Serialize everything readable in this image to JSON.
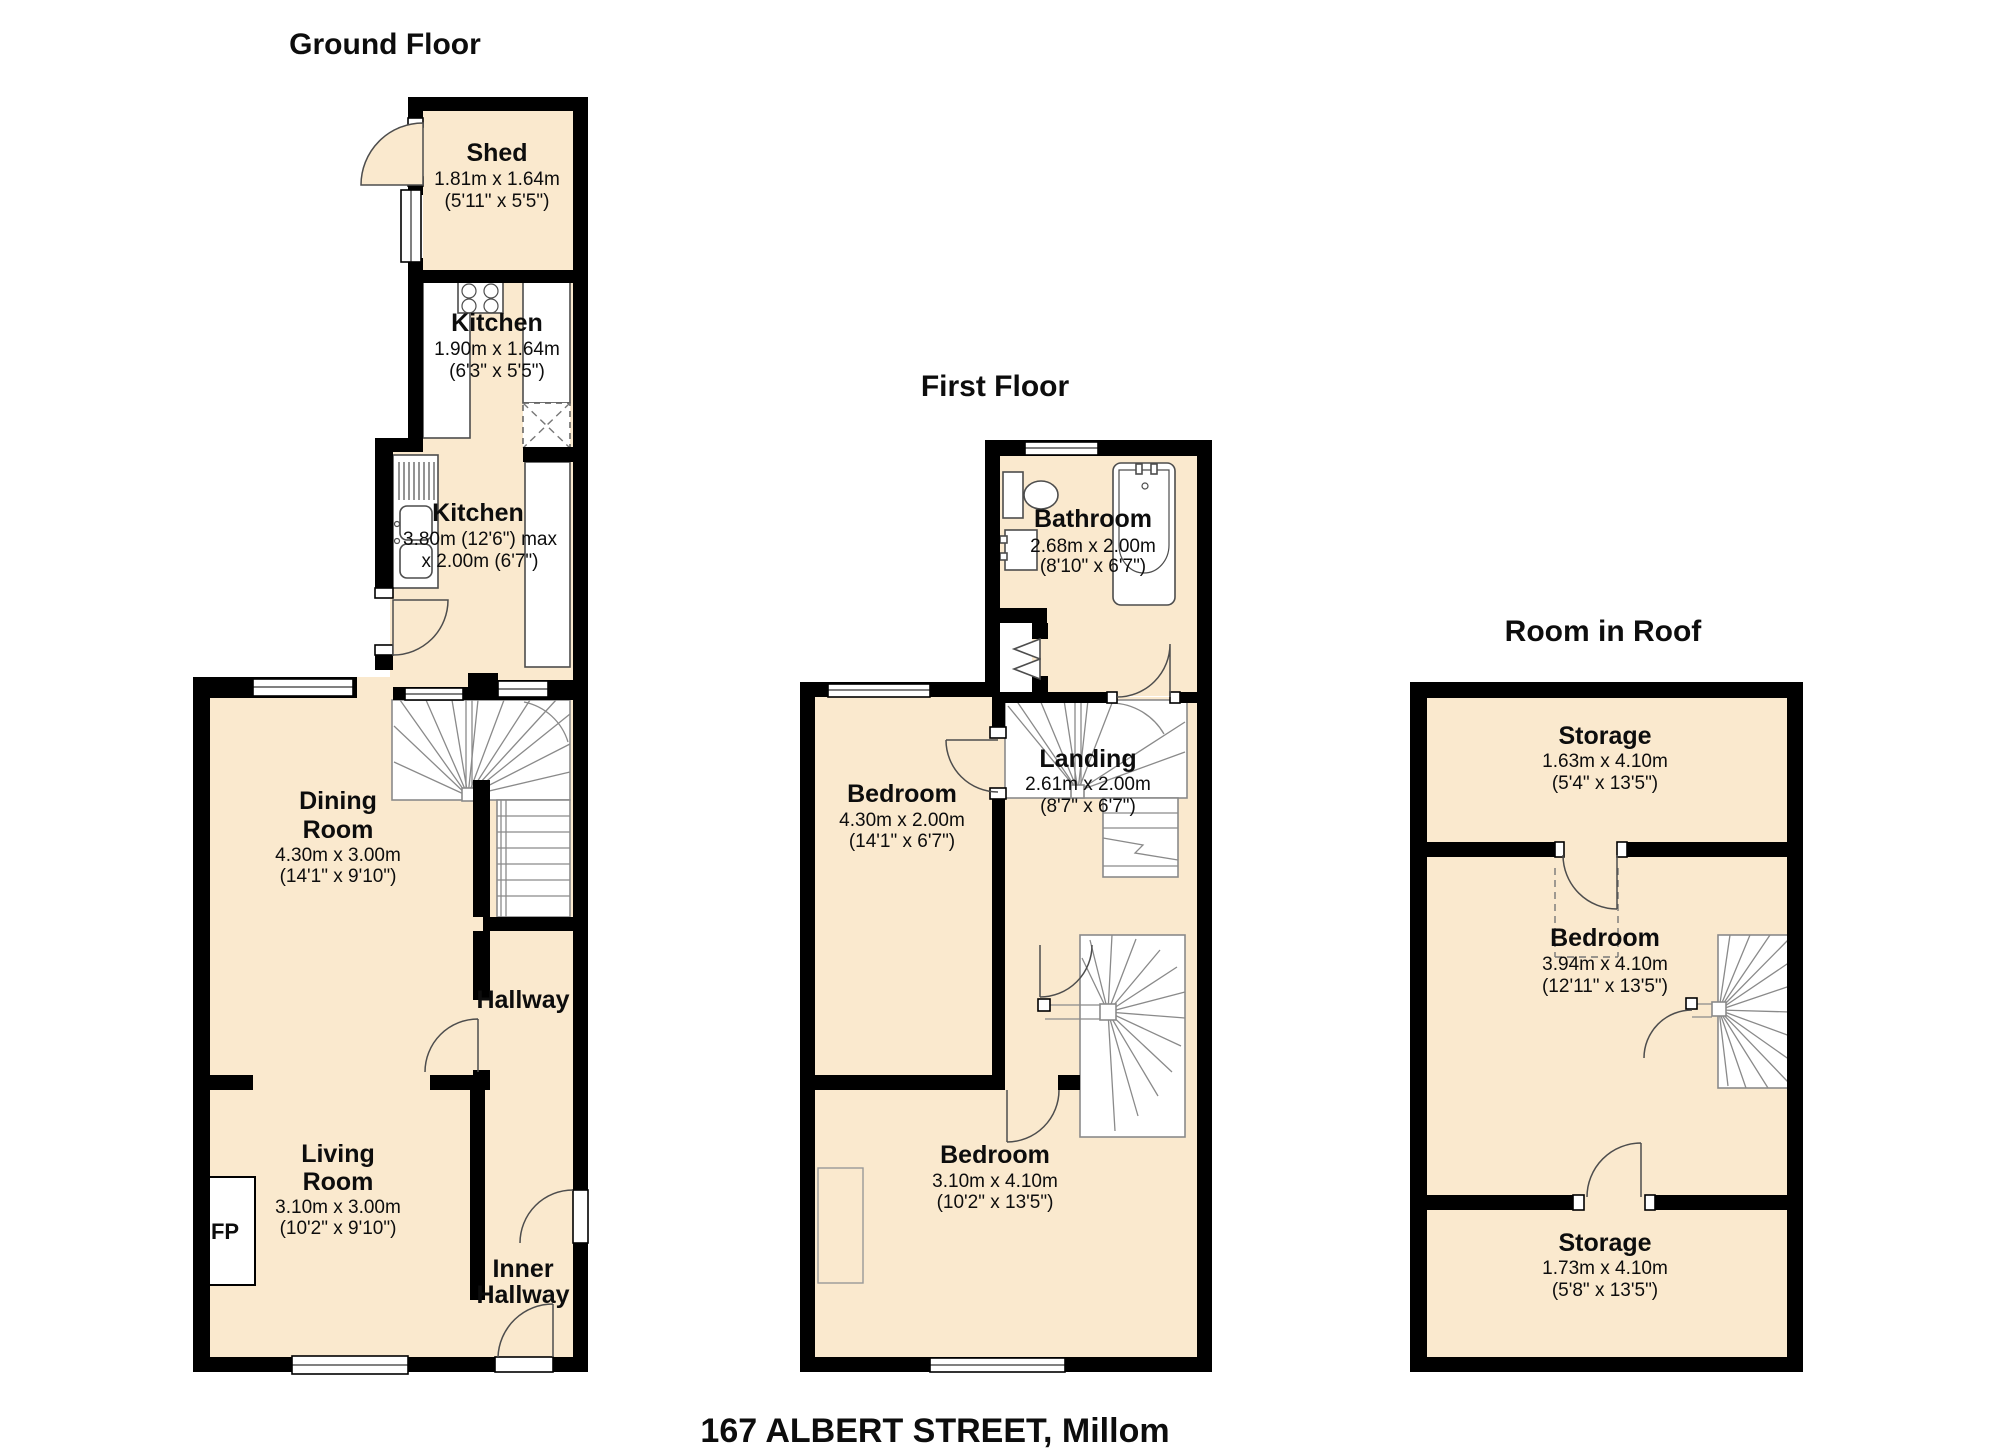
{
  "address_title": "167 ALBERT STREET, Millom",
  "colors": {
    "floor_fill": "#FAE9CE",
    "wall": "#000000",
    "stair_line": "#8a8a8a",
    "fixture_line": "#4d4d4d"
  },
  "floors": {
    "ground": {
      "title": "Ground Floor",
      "rooms": {
        "shed": {
          "name": "Shed",
          "metric": "1.81m x 1.64m",
          "imperial": "(5'11\" x 5'5\")"
        },
        "kitchen_top": {
          "name": "Kitchen",
          "metric": "1.90m x 1.64m",
          "imperial": "(6'3\" x 5'5\")"
        },
        "kitchen_main": {
          "name": "Kitchen",
          "metric": "3.80m (12'6\") max",
          "imperial": "x 2.00m (6'7\")"
        },
        "dining": {
          "name_line1": "Dining",
          "name_line2": "Room",
          "metric": "4.30m x 3.00m",
          "imperial": "(14'1\" x 9'10\")"
        },
        "hallway": {
          "name": "Hallway"
        },
        "living": {
          "name_line1": "Living",
          "name_line2": "Room",
          "metric": "3.10m x 3.00m",
          "imperial": "(10'2\" x 9'10\")"
        },
        "inner_hallway": {
          "name_line1": "Inner",
          "name_line2": "Hallway"
        },
        "fireplace": {
          "label": "FP"
        }
      }
    },
    "first": {
      "title": "First Floor",
      "rooms": {
        "bathroom": {
          "name": "Bathroom",
          "metric": "2.68m x 2.00m",
          "imperial": "(8'10\" x 6'7\")"
        },
        "bedroom_small": {
          "name": "Bedroom",
          "metric": "4.30m x 2.00m",
          "imperial": "(14'1\" x 6'7\")"
        },
        "landing": {
          "name": "Landing",
          "metric": "2.61m x 2.00m",
          "imperial": "(8'7\" x 6'7\")"
        },
        "bedroom_large": {
          "name": "Bedroom",
          "metric": "3.10m x 4.10m",
          "imperial": "(10'2\" x 13'5\")"
        }
      }
    },
    "roof": {
      "title": "Room in Roof",
      "rooms": {
        "storage_top": {
          "name": "Storage",
          "metric": "1.63m x 4.10m",
          "imperial": "(5'4\" x 13'5\")"
        },
        "bedroom": {
          "name": "Bedroom",
          "metric": "3.94m x 4.10m",
          "imperial": "(12'11\" x 13'5\")"
        },
        "storage_bottom": {
          "name": "Storage",
          "metric": "1.73m x 4.10m",
          "imperial": "(5'8\" x 13'5\")"
        }
      }
    }
  }
}
